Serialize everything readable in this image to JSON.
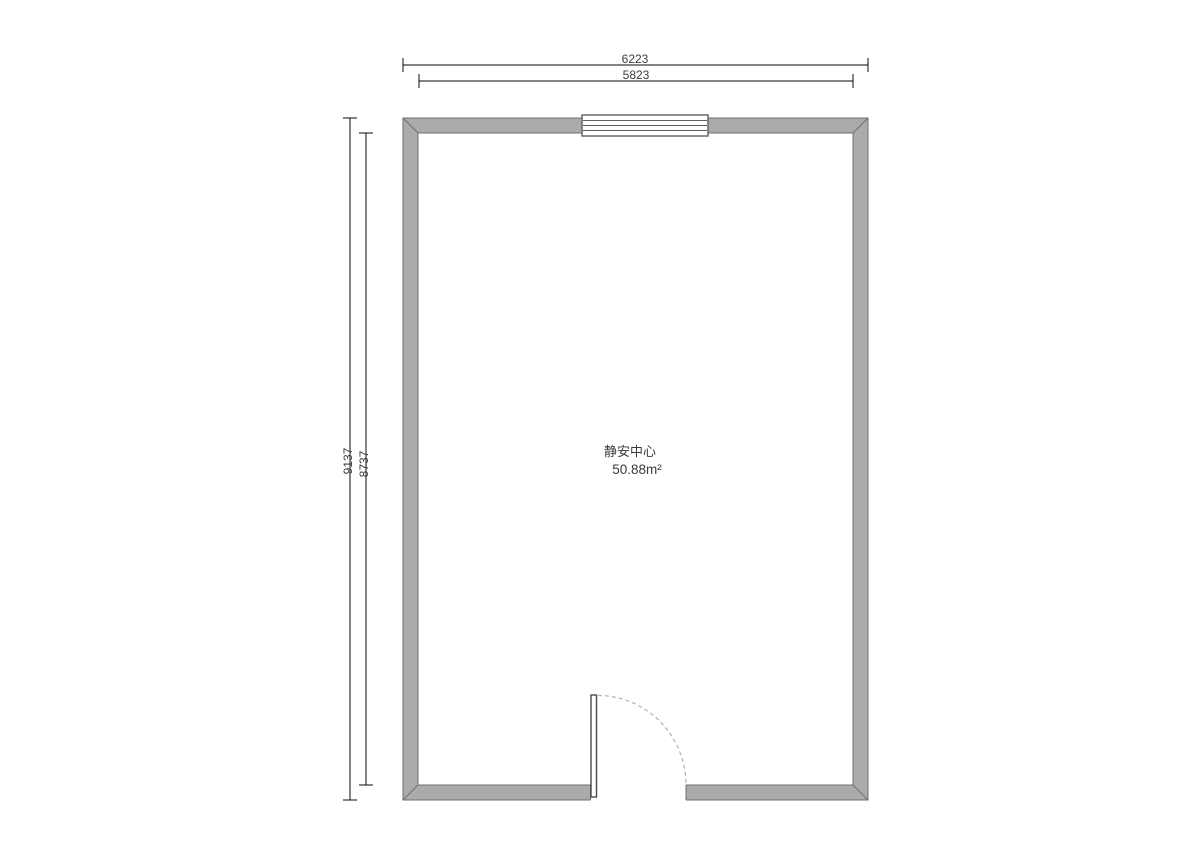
{
  "floorplan": {
    "room": {
      "name": "静安中心",
      "area": "50.88m²"
    },
    "dimensions": {
      "top_outer": "6223",
      "top_inner": "5823",
      "left_outer": "9137",
      "left_inner": "8737"
    },
    "colors": {
      "wall_fill": "#ababab",
      "wall_edge": "#6f6f6f",
      "window_edge": "#5f5f5f",
      "door_leaf_edge": "#4a4a4a",
      "door_arc": "#b3b3b3",
      "dim_line": "#0a0a0a",
      "dim_text": "#3d3d3d",
      "label_text": "#3a3a3a"
    }
  }
}
